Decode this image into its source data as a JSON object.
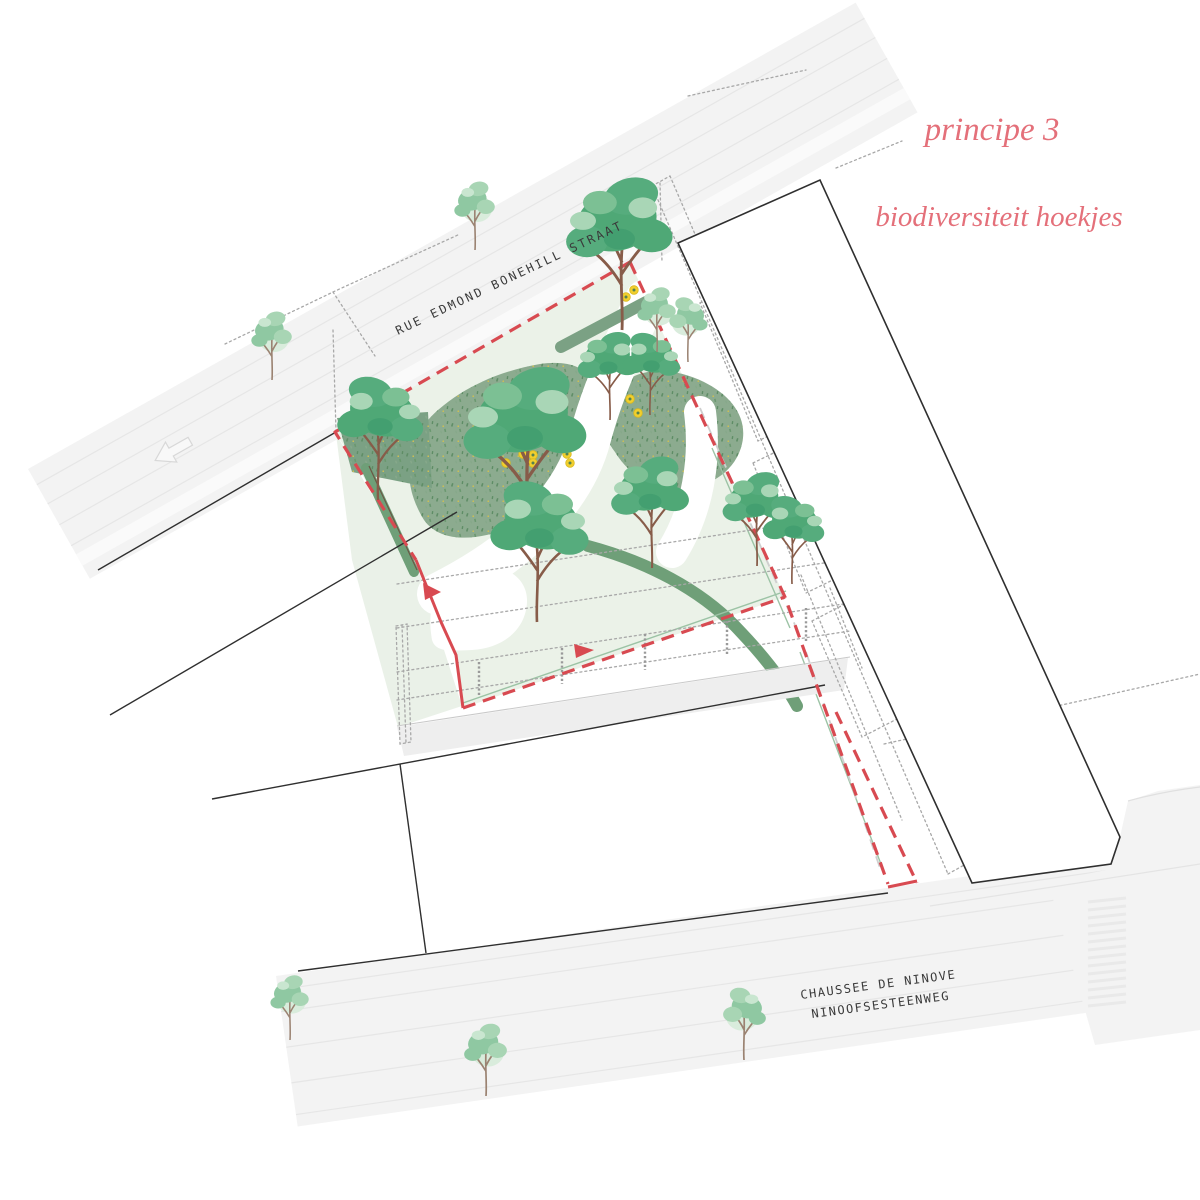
{
  "title": {
    "line1": "principe 3",
    "line2": "biodiversiteit hoekjes"
  },
  "streets": {
    "top": "RUE EDMOND BONEHILL STRAAT",
    "bottom_line1": "CHAUSSEE DE NINOVE",
    "bottom_line2": "NINOOFSESTEENWEG"
  },
  "colors": {
    "title_pink": "#e4707a",
    "boundary_red": "#d84a51",
    "tree_green": "#4fa876",
    "pale_tree_green": "#8fc8a2",
    "meadow_green": "#8cab8f",
    "hedge_green": "#6f9f78",
    "flower_yellow": "#f1cf2d",
    "street_gray": "#f3f3f3",
    "label_dark": "#3a3a3a"
  }
}
